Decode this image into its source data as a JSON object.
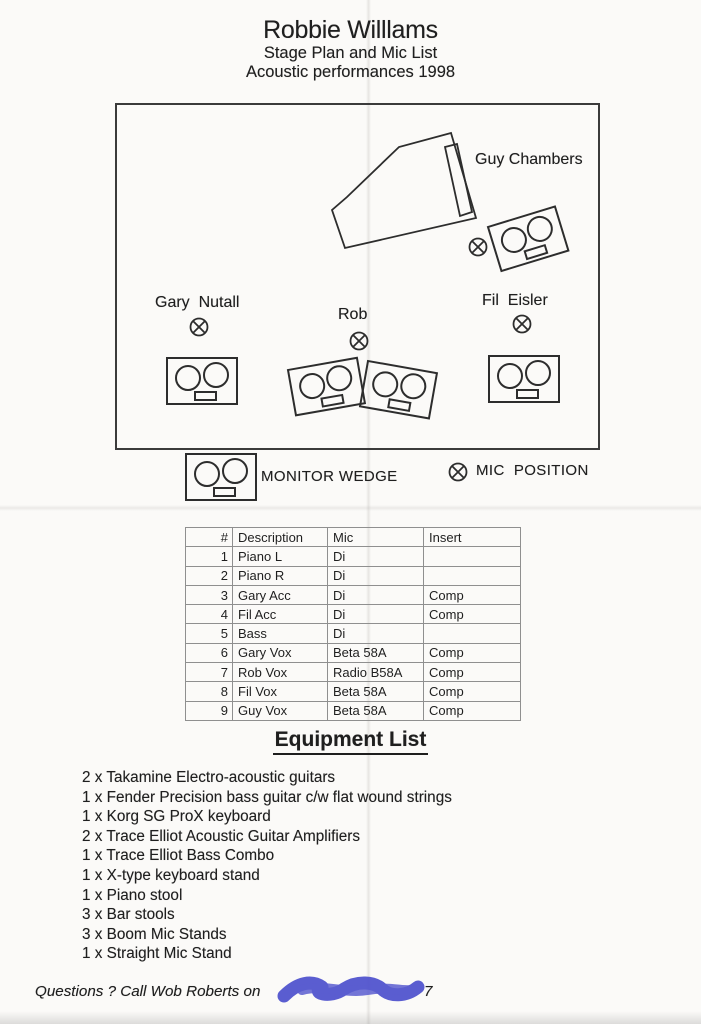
{
  "page": {
    "title": "Robbie Willlams",
    "subtitle1": "Stage Plan and Mic List",
    "subtitle2": "Acoustic performances 1998"
  },
  "stage": {
    "performers": [
      {
        "name": "Guy Chambers"
      },
      {
        "name": "Gary  Nutall"
      },
      {
        "name": "Rob"
      },
      {
        "name": "Fil  Eisler"
      }
    ]
  },
  "legend": {
    "monitor_wedge": "MONITOR WEDGE",
    "mic_position": "MIC  POSITION"
  },
  "icons": {
    "monitor_wedge": "wedge-speaker-with-two-drivers",
    "mic_position": "circle-with-x",
    "grand_piano": "grand-piano-outline"
  },
  "mic_table": {
    "headers": [
      "#",
      "Description",
      "Mic",
      "Insert"
    ],
    "rows": [
      [
        "1",
        "Piano L",
        "Di",
        ""
      ],
      [
        "2",
        "Piano R",
        "Di",
        ""
      ],
      [
        "3",
        "Gary Acc",
        "Di",
        "Comp"
      ],
      [
        "4",
        "Fil Acc",
        "Di",
        "Comp"
      ],
      [
        "5",
        "Bass",
        "Di",
        ""
      ],
      [
        "6",
        "Gary Vox",
        "Beta 58A",
        "Comp"
      ],
      [
        "7",
        "Rob Vox",
        "Radio B58A",
        "Comp"
      ],
      [
        "8",
        "Fil Vox",
        "Beta 58A",
        "Comp"
      ],
      [
        "9",
        "Guy Vox",
        "Beta 58A",
        "Comp"
      ]
    ]
  },
  "equipment": {
    "heading": "Equipment List",
    "items": [
      "2 x Takamine Electro-acoustic guitars",
      "1 x Fender Precision bass guitar c/w flat wound strings",
      "1 x Korg SG ProX keyboard",
      "2 x Trace Elliot Acoustic Guitar Amplifiers",
      "1 x Trace Elliot Bass Combo",
      "1 x X-type keyboard stand",
      "1 x Piano stool",
      "3 x Bar stools",
      "3 x Boom Mic Stands",
      "1 x Straight Mic Stand"
    ]
  },
  "footer": {
    "question_line": "Questions ? Call Wob Roberts on",
    "redacted_tail": "7"
  },
  "colors": {
    "ink": "#1f1f1f",
    "paper": "#fbfaf8",
    "scribble": "#4d50cd"
  }
}
